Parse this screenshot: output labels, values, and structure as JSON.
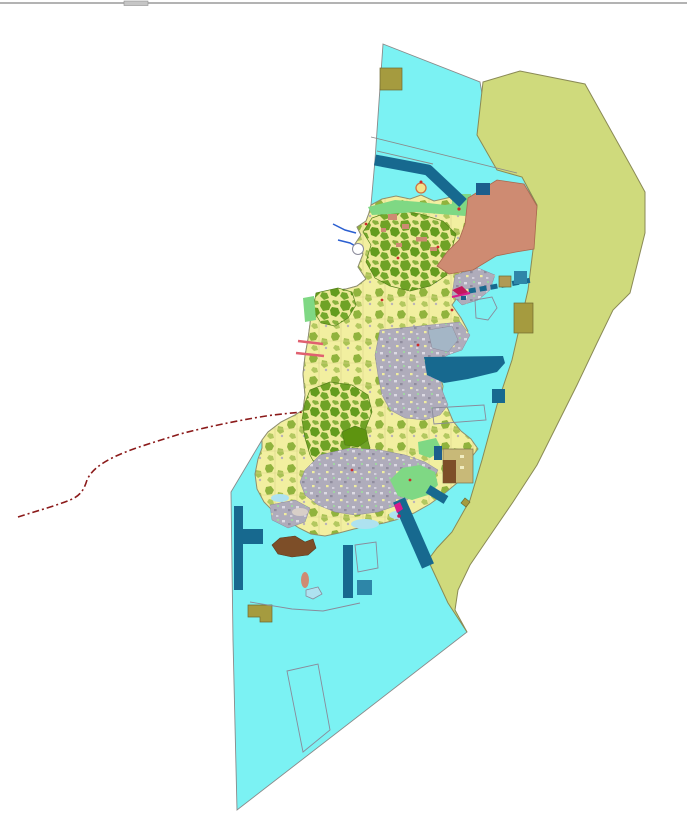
{
  "map": {
    "description_colors": {
      "sea": "#7BF2F3",
      "coastalZone": "#CFDA7C",
      "coastalZoneStroke": "#8a8a55",
      "islandBase": "#F2EFA0",
      "islandStroke": "#8f8f6e",
      "forest": "#6FA226",
      "forestDark": "#5E9410",
      "urban": "#AFACBB",
      "urbanBlue": "#A4B6C6",
      "residential": "#CE8B72",
      "residentialStroke": "#a8684e",
      "greenSpace": "#7FD884",
      "portTeal": "#17698F",
      "navy": "#1C5E8C",
      "tealLight": "#2E86A8",
      "oliveSquare": "#A59B3F",
      "tanSquare": "#B09A55",
      "facilityTan": "#C8B978",
      "brown": "#7D4E28",
      "shallows": "#AEE2F0",
      "paleFlat": "#D8CFC8",
      "boundaryRed": "#8B1A1A",
      "outlineGray": "#8A8A9A",
      "seaOutline": "#8A8A8A",
      "stream": "#2B5FD0",
      "magenta": "#D81B8C",
      "crimson": "#C2185B",
      "redSpot": "#CC2A2A",
      "pink": "#E06070",
      "markerFill": "#F2E28A",
      "markerStroke": "#D07040",
      "topRule": "#9A9A9A",
      "topNotch": "#C6C6C6"
    },
    "features": [
      {
        "id": "sea-area"
      },
      {
        "id": "eastern-coastal-zone"
      },
      {
        "id": "island-landuse-area"
      },
      {
        "id": "northeast-residential-district"
      },
      {
        "id": "forest-areas"
      },
      {
        "id": "urban-areas"
      },
      {
        "id": "green-space-areas"
      },
      {
        "id": "port-harbor-zones"
      },
      {
        "id": "offshore-facility-squares"
      },
      {
        "id": "southwest-brown-flat"
      },
      {
        "id": "marine-boundary-dashdot-line"
      },
      {
        "id": "sea-parcel-outlines"
      }
    ]
  }
}
